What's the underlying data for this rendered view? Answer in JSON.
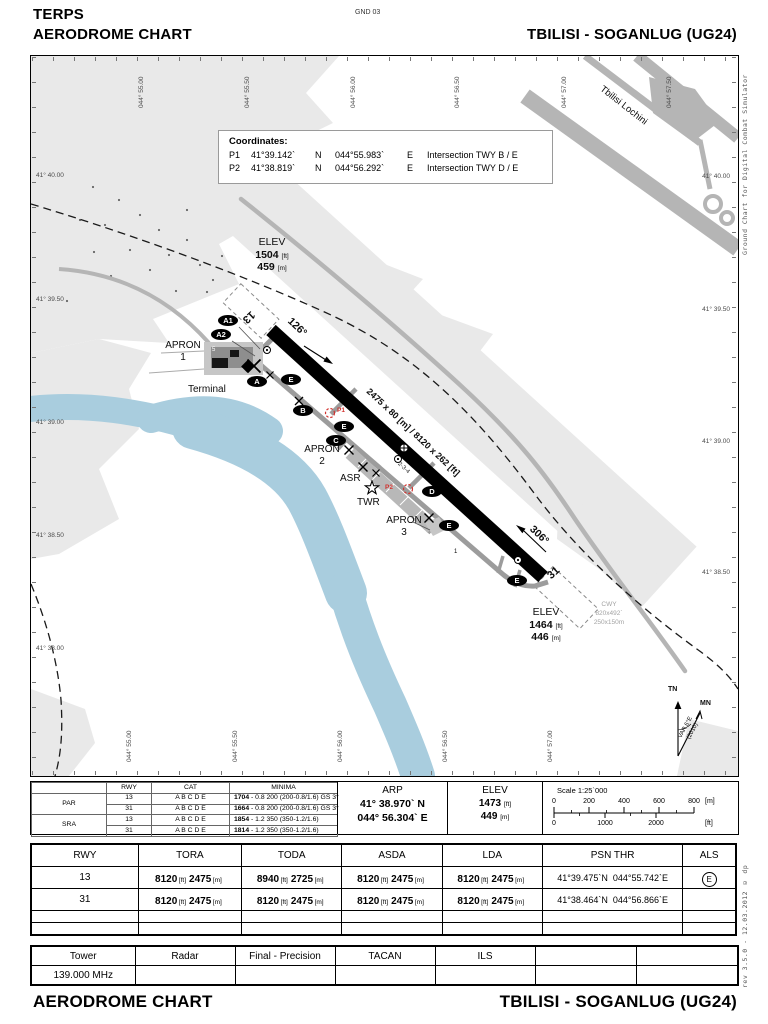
{
  "header": {
    "doc_code": "TERPS",
    "title": "AERODROME CHART",
    "sheet_code": "GND 03",
    "airport": "TBILISI - SOGANLUG (UG24)"
  },
  "footer": {
    "title": "AERODROME CHART",
    "airport": "TBILISI - SOGANLUG (UG24)"
  },
  "side_notes": {
    "top": "Ground Chart for Digital Combat Simulator",
    "bottom": "rev 3.5.0  -  12.03.2012 © dp"
  },
  "colors": {
    "runway": "#000000",
    "taxiway": "#9c9c9c",
    "road": "#b5b5b5",
    "terrain": "#e9e9e9",
    "water": "#a9cdde",
    "marker_red": "#d2322e"
  },
  "map": {
    "coordinates_box": {
      "title": "Coordinates:",
      "points": [
        {
          "id": "P1",
          "lat": "41°39.142`",
          "lat_hem": "N",
          "lon": "044°55.983`",
          "lon_hem": "E",
          "desc": "Intersection TWY B / E"
        },
        {
          "id": "P2",
          "lat": "41°38.819`",
          "lat_hem": "N",
          "lon": "044°56.292`",
          "lon_hem": "E",
          "desc": "Intersection TWY D / E"
        }
      ]
    },
    "elev_13": {
      "label": "ELEV",
      "ft": "1504",
      "ft_unit": "[ft]",
      "m": "459",
      "m_unit": "[m]"
    },
    "elev_31": {
      "label": "ELEV",
      "ft": "1464",
      "ft_unit": "[ft]",
      "m": "446",
      "m_unit": "[m]"
    },
    "cwy": {
      "label": "CWY",
      "dim_ft": "820x492`",
      "dim_m": "250x150m"
    },
    "runway": {
      "num_13": "13",
      "num_31": "31",
      "hdg_13": "126°",
      "hdg_31": "306°",
      "dimensions": "2475 x 80 [m] / 8120 x 262 [ft]"
    },
    "ovals": {
      "a1": "A1",
      "a2": "A2",
      "a": "A",
      "b": "B",
      "c": "C",
      "d": "D",
      "e": "E"
    },
    "sites": {
      "apron": "APRON",
      "apron1_no": "1",
      "apron2_no": "2",
      "apron3_no": "3",
      "terminal": "Terminal",
      "asr": "ASR",
      "twr": "TWR",
      "lochini": "Tbilisi Lochini",
      "stands_234": "2-3-4",
      "stand_5": "5",
      "stand_1": "1",
      "p1": "P1",
      "p2": "P2"
    },
    "compass": {
      "tn": "TN",
      "mn": "MN",
      "var1": "VAR 6°E",
      "var2": "(2010)"
    },
    "graticule": {
      "top": [
        "044° 55.00",
        "044° 55.50",
        "044° 56.00",
        "044° 56.50",
        "044° 57.00",
        "044° 57.50"
      ],
      "bottom": [
        "044° 55.00",
        "044° 55.50",
        "044° 56.00",
        "044° 56.50",
        "044° 57.00"
      ],
      "left": [
        "41° 40.00",
        "41° 39.50",
        "41° 39.00",
        "41° 38.50",
        "41° 38.00"
      ],
      "right": [
        "41° 40.00",
        "41° 39.50",
        "41° 39.00",
        "41° 38.50"
      ]
    }
  },
  "minima_table": {
    "headers": {
      "rwy": "RWY",
      "cat": "CAT",
      "minima": "MINIMA"
    },
    "groups": [
      {
        "name": "PAR",
        "rows": [
          {
            "rwy": "13",
            "cat": "A B C D E",
            "min": "1704",
            "rest": " - 0.8 200 (200-0.8/1.6) GS 3°"
          },
          {
            "rwy": "31",
            "cat": "A B C D E",
            "min": "1664",
            "rest": " - 0.8 200 (200-0.8/1.6) GS 3°"
          }
        ]
      },
      {
        "name": "SRA",
        "rows": [
          {
            "rwy": "13",
            "cat": "A B C D E",
            "min": "1854",
            "rest": " - 1.2 350 (350-1.2/1.6)"
          },
          {
            "rwy": "31",
            "cat": "A B C D E",
            "min": "1814",
            "rest": " - 1.2 350 (350-1.2/1.6)"
          }
        ]
      }
    ]
  },
  "arp_box": {
    "title": "ARP",
    "lat": "41° 38.970` N",
    "lon": "044° 56.304` E"
  },
  "elev_box": {
    "title": "ELEV",
    "ft": "1473",
    "m": "449"
  },
  "scale_box": {
    "title": "Scale 1:25`000",
    "m_labels": [
      "0",
      "200",
      "400",
      "600",
      "800"
    ],
    "ft_labels": [
      "0",
      "1000",
      "2000"
    ],
    "m_unit": "[m]",
    "ft_unit": "[ft]"
  },
  "units": {
    "ft": "[ft]",
    "m": "[m]"
  },
  "runway_table": {
    "headers": [
      "RWY",
      "TORA",
      "TODA",
      "ASDA",
      "LDA",
      "PSN THR",
      "ALS"
    ],
    "rows": [
      {
        "rwy": "13",
        "tora_ft": "8120",
        "tora_m": "2475",
        "toda_ft": "8940",
        "toda_m": "2725",
        "asda_ft": "8120",
        "asda_m": "2475",
        "lda_ft": "8120",
        "lda_m": "2475",
        "psn_lat": "41°39.475`N",
        "psn_lon": "044°55.742`E",
        "als": "E"
      },
      {
        "rwy": "31",
        "tora_ft": "8120",
        "tora_m": "2475",
        "toda_ft": "8120",
        "toda_m": "2475",
        "asda_ft": "8120",
        "asda_m": "2475",
        "lda_ft": "8120",
        "lda_m": "2475",
        "psn_lat": "41°38.464`N",
        "psn_lon": "044°56.866`E",
        "als": ""
      }
    ]
  },
  "freq_table": {
    "headers": [
      "Tower",
      "Radar",
      "Final - Precision",
      "TACAN",
      "ILS"
    ],
    "tower_freq": "139.000 MHz"
  }
}
